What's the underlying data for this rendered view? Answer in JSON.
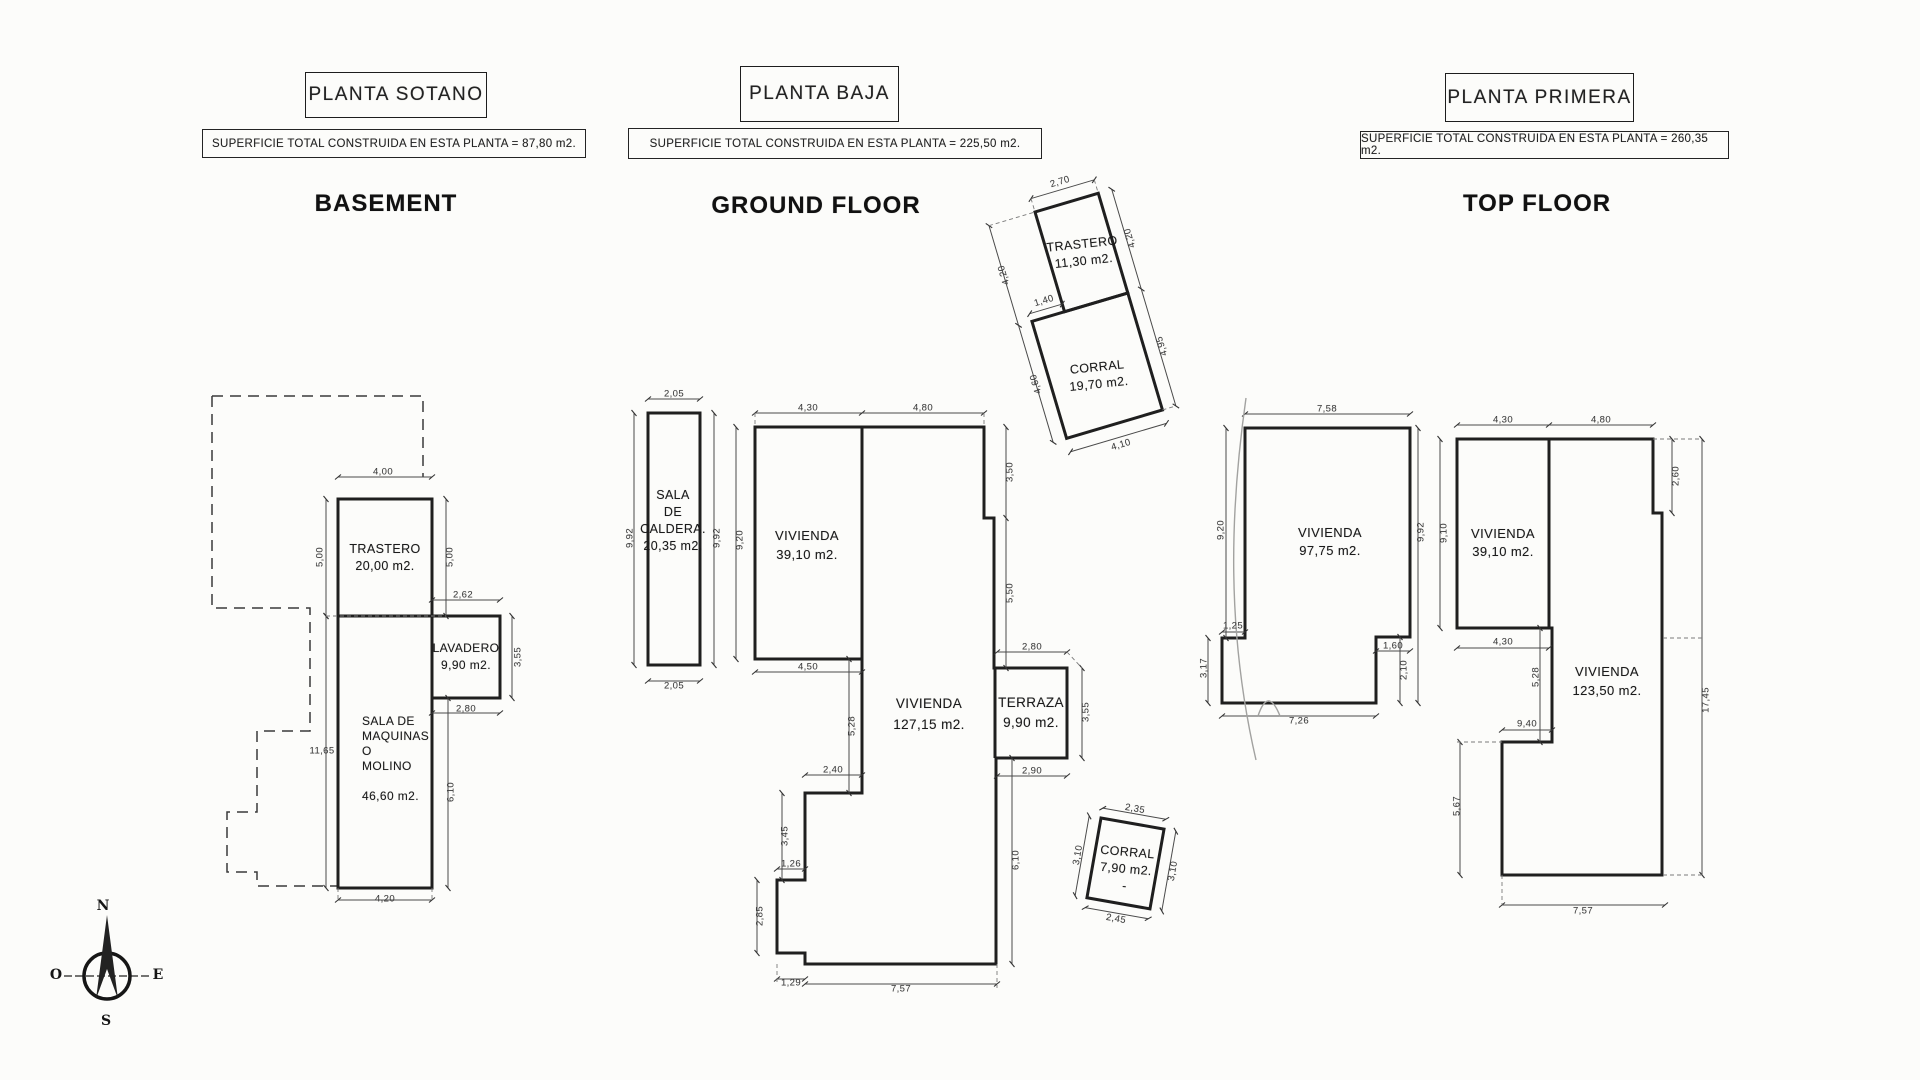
{
  "colors": {
    "paper": "#fcfcfa",
    "ink": "#1f1f1f",
    "dim_text": "#3f3f3f"
  },
  "plans": [
    {
      "title": "PLANTA SOTANO",
      "superficie": "SUPERFICIE TOTAL CONSTRUIDA EN ESTA PLANTA = 87,80 m2.",
      "heading": "BASEMENT"
    },
    {
      "title": "PLANTA BAJA",
      "superficie": "SUPERFICIE TOTAL CONSTRUIDA EN ESTA PLANTA = 225,50 m2.",
      "heading": "GROUND FLOOR"
    },
    {
      "title": "PLANTA PRIMERA",
      "superficie": "SUPERFICIE TOTAL CONSTRUIDA EN ESTA PLANTA = 260,35 m2.",
      "heading": "TOP FLOOR"
    }
  ],
  "compass": {
    "n": "N",
    "e": "E",
    "s": "S",
    "o": "O"
  },
  "rooms": [
    {
      "plan": "basement",
      "lines": [
        "TRASTERO",
        "20,00 m2."
      ],
      "x": 385,
      "y": 541,
      "lh": 17,
      "fs": 12.5,
      "align": "center",
      "r": 0
    },
    {
      "plan": "basement",
      "lines": [
        "LAVADERO",
        "9,90 m2."
      ],
      "x": 466,
      "y": 640,
      "lh": 17,
      "fs": 12,
      "align": "center",
      "r": 0
    },
    {
      "plan": "basement",
      "lines": [
        "SALA DE",
        "MAQUINAS",
        "O",
        "MOLINO",
        " ",
        "46,60 m2."
      ],
      "x": 362,
      "y": 714,
      "lh": 15,
      "fs": 12,
      "align": "left",
      "r": 0
    },
    {
      "plan": "ground",
      "lines": [
        "SALA",
        "DE",
        "CALDERA.",
        "20,35 m2."
      ],
      "x": 673,
      "y": 487,
      "lh": 17,
      "fs": 12.5,
      "align": "center",
      "r": 0
    },
    {
      "plan": "ground",
      "lines": [
        "VIVIENDA",
        "39,10 m2."
      ],
      "x": 807,
      "y": 526,
      "lh": 19,
      "fs": 13,
      "align": "center",
      "r": 0
    },
    {
      "plan": "ground",
      "lines": [
        "VIVIENDA",
        "127,15 m2."
      ],
      "x": 929,
      "y": 693,
      "lh": 21,
      "fs": 13.5,
      "align": "center",
      "r": 0
    },
    {
      "plan": "ground",
      "lines": [
        "TERRAZA",
        "9,90 m2."
      ],
      "x": 1031,
      "y": 693,
      "lh": 20,
      "fs": 13.5,
      "align": "center",
      "r": 0
    },
    {
      "plan": "ground",
      "lines": [
        "TRASTERO",
        "11,30 m2."
      ],
      "x": 1083,
      "y": 236,
      "lh": 17,
      "fs": 12.5,
      "align": "center",
      "r": -6
    },
    {
      "plan": "ground",
      "lines": [
        "CORRAL",
        "19,70 m2."
      ],
      "x": 1098,
      "y": 359,
      "lh": 17,
      "fs": 12.5,
      "align": "center",
      "r": -6
    },
    {
      "plan": "ground",
      "lines": [
        "CORRAL",
        "7,90 m2.",
        "-"
      ],
      "x": 1126,
      "y": 844,
      "lh": 17,
      "fs": 12.5,
      "align": "center",
      "r": 5
    },
    {
      "plan": "top",
      "lines": [
        "VIVIENDA",
        "97,75 m2."
      ],
      "x": 1330,
      "y": 524,
      "lh": 18,
      "fs": 13,
      "align": "center",
      "r": 0
    },
    {
      "plan": "top",
      "lines": [
        "VIVIENDA",
        "39,10 m2."
      ],
      "x": 1503,
      "y": 525,
      "lh": 18,
      "fs": 13,
      "align": "center",
      "r": 0
    },
    {
      "plan": "top",
      "lines": [
        "VIVIENDA",
        "123,50 m2."
      ],
      "x": 1607,
      "y": 662,
      "lh": 19,
      "fs": 13,
      "align": "center",
      "r": 0
    }
  ],
  "dims": [
    {
      "t": "4,00",
      "x": 383,
      "y": 472,
      "r": 0
    },
    {
      "t": "5,00",
      "x": 320,
      "y": 557,
      "r": -90
    },
    {
      "t": "5,00",
      "x": 450,
      "y": 557,
      "r": -90
    },
    {
      "t": "2,62",
      "x": 463,
      "y": 595,
      "r": 0
    },
    {
      "t": "3,55",
      "x": 518,
      "y": 657,
      "r": -90
    },
    {
      "t": "2,80",
      "x": 466,
      "y": 709,
      "r": 0
    },
    {
      "t": "11,65",
      "x": 322,
      "y": 751,
      "r": 0
    },
    {
      "t": "6,10",
      "x": 451,
      "y": 792,
      "r": -90
    },
    {
      "t": "4,20",
      "x": 385,
      "y": 899,
      "r": 0
    },
    {
      "t": "2,05",
      "x": 674,
      "y": 394,
      "r": 0
    },
    {
      "t": "9,92",
      "x": 630,
      "y": 538,
      "r": -90
    },
    {
      "t": "9,92",
      "x": 717,
      "y": 538,
      "r": -90
    },
    {
      "t": "9,20",
      "x": 740,
      "y": 540,
      "r": -90
    },
    {
      "t": "2,05",
      "x": 674,
      "y": 686,
      "r": 0
    },
    {
      "t": "4,30",
      "x": 808,
      "y": 408,
      "r": 0
    },
    {
      "t": "4,80",
      "x": 923,
      "y": 408,
      "r": 0
    },
    {
      "t": "3,50",
      "x": 1010,
      "y": 472,
      "r": -90
    },
    {
      "t": "5,50",
      "x": 1010,
      "y": 593,
      "r": -90
    },
    {
      "t": "2,80",
      "x": 1032,
      "y": 647,
      "r": 0
    },
    {
      "t": "3,55",
      "x": 1086,
      "y": 712,
      "r": -90
    },
    {
      "t": "2,90",
      "x": 1032,
      "y": 771,
      "r": 0
    },
    {
      "t": "6,10",
      "x": 1016,
      "y": 860,
      "r": -90
    },
    {
      "t": "4,50",
      "x": 808,
      "y": 667,
      "r": 0
    },
    {
      "t": "5,28",
      "x": 852,
      "y": 726,
      "r": -90
    },
    {
      "t": "2,40",
      "x": 833,
      "y": 770,
      "r": 0
    },
    {
      "t": "3,45",
      "x": 785,
      "y": 836,
      "r": -90
    },
    {
      "t": "1,26",
      "x": 791,
      "y": 864,
      "r": 0
    },
    {
      "t": "2,85",
      "x": 760,
      "y": 916,
      "r": -90
    },
    {
      "t": "1,29",
      "x": 791,
      "y": 983,
      "r": 0
    },
    {
      "t": "7,57",
      "x": 901,
      "y": 989,
      "r": 0
    },
    {
      "t": "2,70",
      "x": 1060,
      "y": 182,
      "r": -16.5
    },
    {
      "t": "4,20",
      "x": 1004,
      "y": 275,
      "r": -106.5
    },
    {
      "t": "4,20",
      "x": 1130,
      "y": 238,
      "r": -106.5
    },
    {
      "t": "1,40",
      "x": 1044,
      "y": 301,
      "r": -16.5
    },
    {
      "t": "4,60",
      "x": 1036,
      "y": 384,
      "r": -106.5
    },
    {
      "t": "4,95",
      "x": 1162,
      "y": 346,
      "r": -106.5
    },
    {
      "t": "4,10",
      "x": 1121,
      "y": 445,
      "r": -16.5
    },
    {
      "t": "2,35",
      "x": 1135,
      "y": 809,
      "r": 10
    },
    {
      "t": "3,10",
      "x": 1078,
      "y": 855,
      "r": -80
    },
    {
      "t": "3,10",
      "x": 1173,
      "y": 871,
      "r": -80
    },
    {
      "t": "2,45",
      "x": 1116,
      "y": 919,
      "r": 10
    },
    {
      "t": "7,58",
      "x": 1327,
      "y": 409,
      "r": 0
    },
    {
      "t": "9,20",
      "x": 1221,
      "y": 530,
      "r": -90
    },
    {
      "t": "9,92",
      "x": 1421,
      "y": 532,
      "r": -90
    },
    {
      "t": "9,10",
      "x": 1444,
      "y": 533,
      "r": -90
    },
    {
      "t": "1,25",
      "x": 1233,
      "y": 626,
      "r": 0
    },
    {
      "t": "3,17",
      "x": 1204,
      "y": 668,
      "r": -90
    },
    {
      "t": "1,60",
      "x": 1393,
      "y": 646,
      "r": 0
    },
    {
      "t": "2,10",
      "x": 1404,
      "y": 670,
      "r": -90
    },
    {
      "t": "7,26",
      "x": 1299,
      "y": 721,
      "r": 0
    },
    {
      "t": "4,30",
      "x": 1503,
      "y": 420,
      "r": 0
    },
    {
      "t": "4,80",
      "x": 1601,
      "y": 420,
      "r": 0
    },
    {
      "t": "2,60",
      "x": 1676,
      "y": 476,
      "r": -90
    },
    {
      "t": "17,45",
      "x": 1706,
      "y": 700,
      "r": -90
    },
    {
      "t": "4,30",
      "x": 1503,
      "y": 642,
      "r": 0
    },
    {
      "t": "5,28",
      "x": 1536,
      "y": 677,
      "r": -90
    },
    {
      "t": "9,40",
      "x": 1527,
      "y": 724,
      "r": 0
    },
    {
      "t": "5,67",
      "x": 1457,
      "y": 806,
      "r": -90
    },
    {
      "t": "7,57",
      "x": 1583,
      "y": 911,
      "r": 0
    }
  ]
}
